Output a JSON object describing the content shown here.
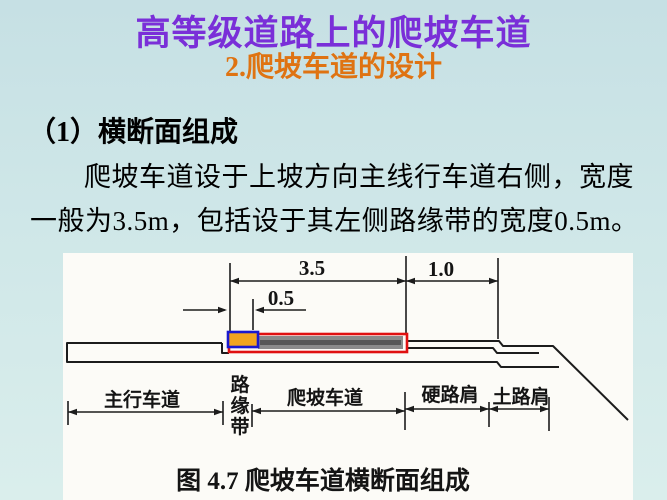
{
  "slide": {
    "title": "高等级道路上的爬坡车道",
    "subtitle": "2.爬坡车道的设计"
  },
  "body": {
    "section_heading": "（1）横断面组成",
    "paragraph_lines": [
      "爬坡车道设于上坡方向主线行车道右侧，宽度",
      "一般为3.5m，包括设于其左侧路缘带的宽度0.5m。"
    ]
  },
  "figure": {
    "caption": "图 4.7  爬坡车道横断面组成",
    "dimensions": {
      "climbing_lane_width_m": "3.5",
      "hard_shoulder_width_m": "1.0",
      "curb_strip_width_m": "0.5"
    },
    "labels": {
      "main_lane": "主行车道",
      "curb_strip": "路缘带",
      "climbing_lane": "爬坡车道",
      "hard_shoulder": "硬路肩",
      "soil_shoulder": "土路肩"
    },
    "colors": {
      "curb_strip_fill": "#f2a41f",
      "curb_strip_outline": "#1a18cf",
      "climbing_lane_outline": "#e01010",
      "climbing_lane_fill": "#8a8a8a",
      "line_color": "#1c1c1c"
    }
  },
  "theme": {
    "title_color": "#7a2fd8",
    "subtitle_color": "#df7312",
    "background_top": "#c6e0e4",
    "background_bottom": "#daeeec",
    "panel_background": "#fcfbf7"
  }
}
